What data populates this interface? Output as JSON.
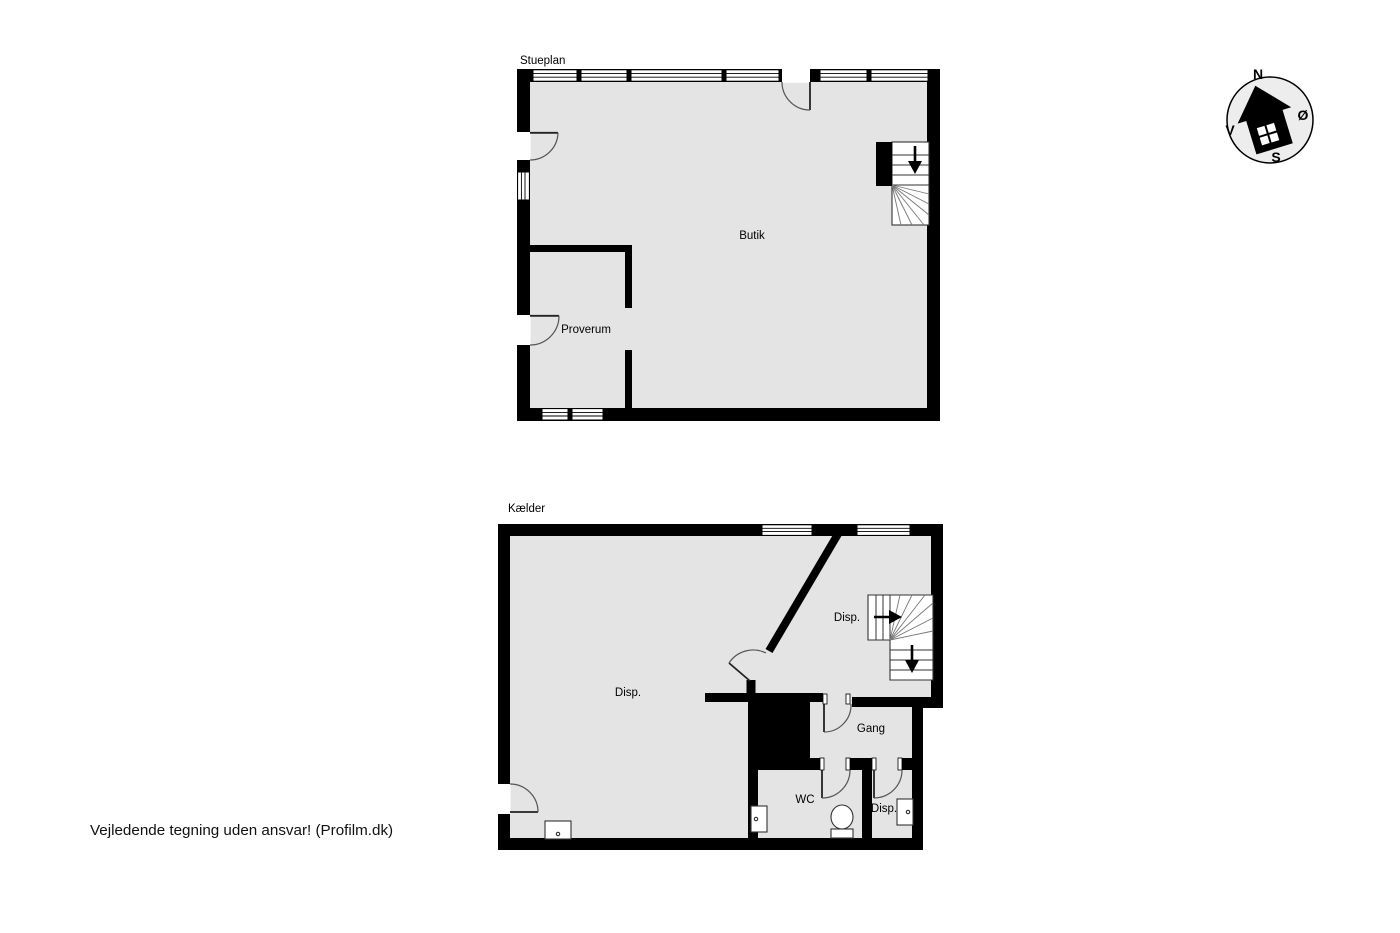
{
  "page": {
    "disclaimer": "Vejledende tegning uden ansvar! (Profilm.dk)"
  },
  "colors": {
    "floor_fill": "#e4e4e4",
    "wall": "#000000",
    "background": "#ffffff"
  },
  "floors": {
    "stueplan": {
      "title": "Stueplan",
      "rooms": {
        "butik": "Butik",
        "proverum": "Proverum"
      }
    },
    "kaelder": {
      "title": "Kælder",
      "rooms": {
        "disp_main": "Disp.",
        "disp_upper": "Disp.",
        "gang": "Gang",
        "wc": "WC",
        "disp_lower": "Disp."
      }
    }
  },
  "compass": {
    "north": "N",
    "east": "Ø",
    "south": "S",
    "west": "V"
  }
}
